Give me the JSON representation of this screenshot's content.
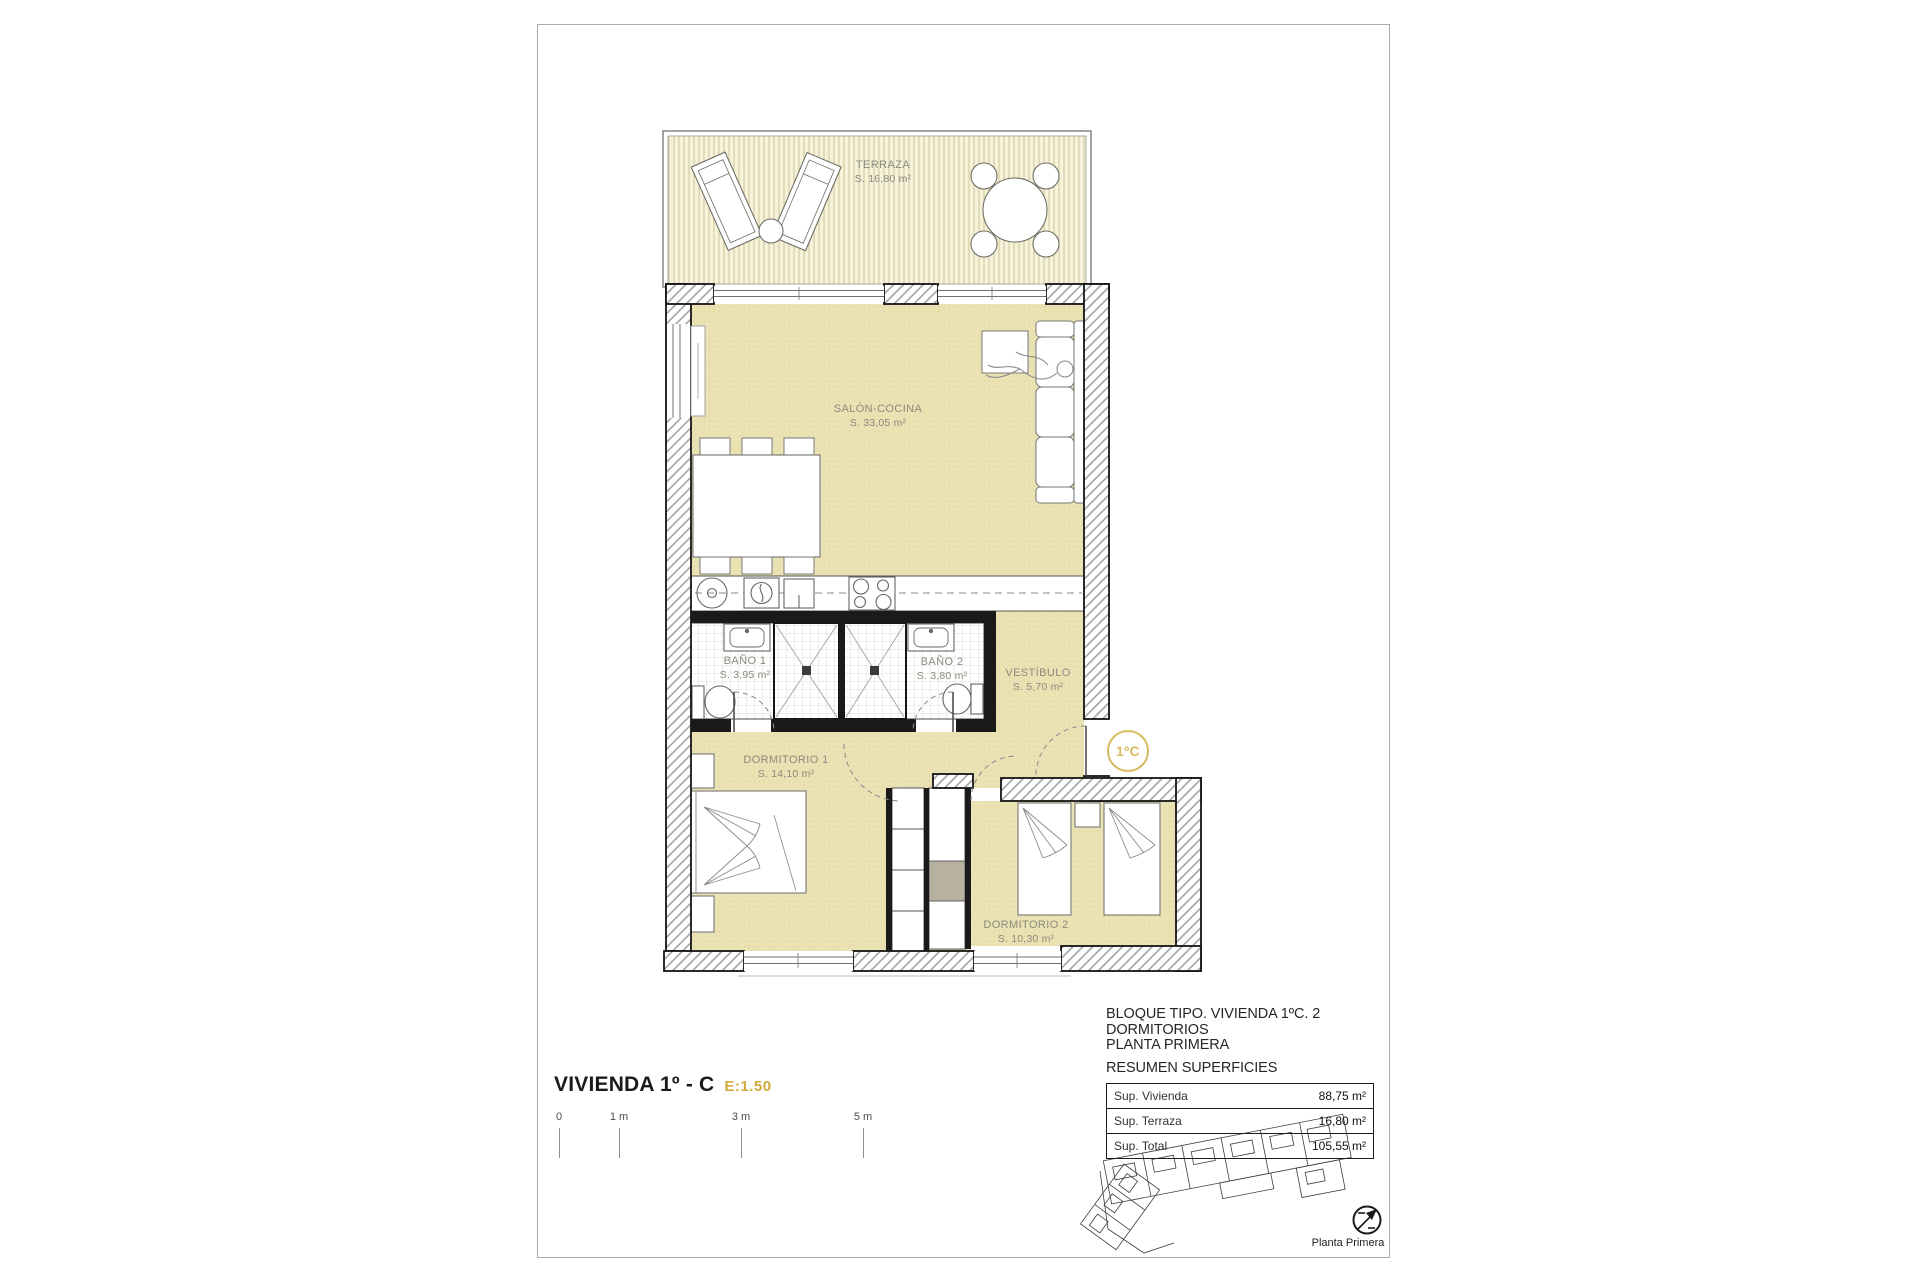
{
  "colors": {
    "gold": "#D1A93C",
    "gold2": "#D6BB60",
    "floor_tan": "#EBE2B4",
    "terrace_cream": "#F7F2DA",
    "terrace_stripe": "#CFC9A0",
    "label_gray": "#8B8B7E"
  },
  "plan": {
    "unit_badge": "1ºC",
    "rooms": [
      {
        "name": "TERRAZA",
        "area": "S. 16,80 m²"
      },
      {
        "name": "SALÓN-COCINA",
        "area": "S. 33,05 m²"
      },
      {
        "name": "BAÑO 1",
        "area": "S. 3,95 m²"
      },
      {
        "name": "BAÑO 2",
        "area": "S. 3,80 m²"
      },
      {
        "name": "VESTÍBULO",
        "area": "S. 5,70 m²"
      },
      {
        "name": "DORMITORIO 1",
        "area": "S. 14,10 m²"
      },
      {
        "name": "DORMITORIO 2",
        "area": "S. 10,30 m²"
      }
    ]
  },
  "title_block": {
    "title": "VIVIENDA 1º - C",
    "scale": "E:1.50"
  },
  "scale_bar": {
    "ticks": [
      "0",
      "1 m",
      "3 m",
      "5 m"
    ]
  },
  "summary": {
    "line1": "BLOQUE TIPO. VIVIENDA 1ºC. 2 DORMITORIOS",
    "line2": "PLANTA PRIMERA",
    "line3": "RESUMEN SUPERFICIES",
    "rows": [
      {
        "label": "Sup. Vivienda",
        "value": "88,75 m²"
      },
      {
        "label": "Sup. Terraza",
        "value": "16,80 m²"
      },
      {
        "label": "Sup. Total",
        "value": "105,55 m²"
      }
    ]
  },
  "site_plan": {
    "caption": "Planta Primera"
  }
}
